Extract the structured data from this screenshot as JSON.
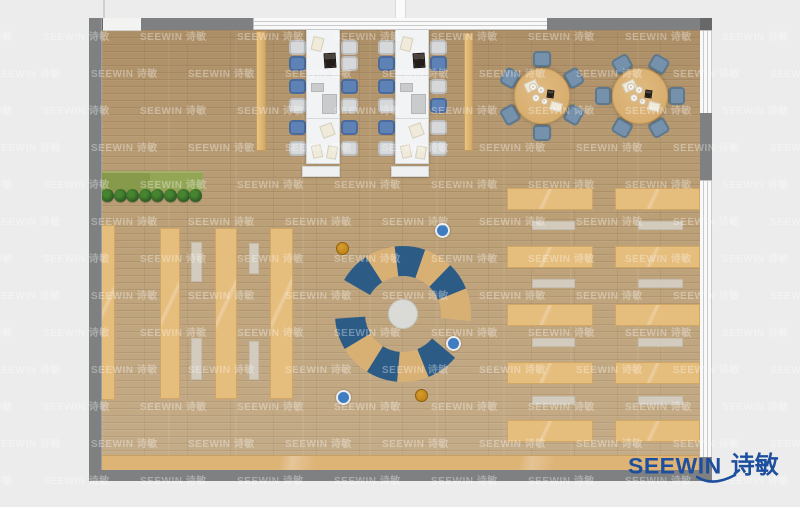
{
  "scene": {
    "description": "top-down furniture layout floor plan of a library reading room",
    "background_color": "#ebeceb",
    "wall_color": "#7e8081",
    "floor_color": "#bca077"
  },
  "watermark": {
    "text": "SEEWIN 诗敏",
    "color": "rgba(255,255,255,0.34)"
  },
  "logo": {
    "brand": "SEEWIN",
    "chinese": "诗敏",
    "color": "#1e4f9f"
  },
  "planter": {
    "plants": 8,
    "x": 101,
    "y": 189,
    "spacing": 12.6
  },
  "desk_area": {
    "chair_tops": [
      11,
      27,
      50,
      69,
      91,
      112
    ],
    "units": [
      {
        "x": 289,
        "chairs_left": [
          "gray",
          "blue",
          "blue",
          "gray",
          "blue",
          "gray"
        ],
        "chairs_right": [
          "gray",
          "gray",
          "blue",
          "gray",
          "blue",
          "gray"
        ]
      },
      {
        "x": 378,
        "chairs_left": [
          "gray",
          "blue",
          "blue",
          "gray",
          "blue",
          "gray"
        ],
        "chairs_right": [
          "gray",
          "blue",
          "gray",
          "blue",
          "gray",
          "gray"
        ]
      }
    ],
    "table_items": [
      {
        "x": 5,
        "y": 7,
        "w": 11,
        "h": 14,
        "rot": 14,
        "type": "paper"
      },
      {
        "x": 17,
        "y": 23,
        "w": 12,
        "h": 15,
        "rot": -4,
        "type": "laptop"
      },
      {
        "x": 4,
        "y": 53,
        "w": 13,
        "h": 9,
        "rot": 0,
        "type": "panel"
      },
      {
        "x": 15,
        "y": 64,
        "w": 15,
        "h": 20,
        "rot": 0,
        "type": "panel"
      },
      {
        "x": 14,
        "y": 94,
        "w": 13,
        "h": 13,
        "rot": -20,
        "type": "paper"
      },
      {
        "x": 5,
        "y": 115,
        "w": 10,
        "h": 13,
        "rot": -12,
        "type": "paper"
      },
      {
        "x": 20,
        "y": 116,
        "w": 10,
        "h": 13,
        "rot": 10,
        "type": "paper"
      }
    ]
  },
  "round_tables": {
    "radius": 28,
    "chair_radius": 37,
    "tables": [
      {
        "cx": 542,
        "cy": 96,
        "angles": [
          270,
          330,
          30,
          90,
          150,
          210
        ]
      },
      {
        "cx": 640,
        "cy": 96,
        "angles": [
          0,
          60,
          120,
          180,
          240,
          300
        ]
      }
    ],
    "items": [
      {
        "dx": -17,
        "dy": -15,
        "w": 13,
        "h": 10,
        "rot": -25,
        "type": "paper"
      },
      {
        "dx": 8,
        "dy": 6,
        "w": 12,
        "h": 9,
        "rot": 15,
        "type": "paper"
      },
      {
        "dx": 5,
        "dy": -6,
        "w": 7,
        "h": 8,
        "rot": 8,
        "type": "laptop"
      },
      {
        "dx": -9,
        "dy": -9,
        "r": 4,
        "type": "plate"
      },
      {
        "dx": -1,
        "dy": -6,
        "r": 4,
        "type": "plate"
      },
      {
        "dx": -6,
        "dy": 2,
        "r": 4,
        "type": "plate"
      },
      {
        "dx": 2,
        "dy": 5,
        "r": 3.5,
        "type": "plate"
      }
    ]
  },
  "shelving_left": {
    "strips": [
      {
        "x": 100,
        "y": 225,
        "w": 15,
        "h": 175
      },
      {
        "x": 160,
        "y": 228,
        "w": 20,
        "h": 171
      },
      {
        "x": 215,
        "y": 228,
        "w": 22,
        "h": 171
      },
      {
        "x": 270,
        "y": 228,
        "w": 23,
        "h": 171
      }
    ],
    "benches": [
      {
        "x": 191,
        "y": 242,
        "w": 11,
        "h": 40
      },
      {
        "x": 191,
        "y": 338,
        "w": 11,
        "h": 42
      },
      {
        "x": 249,
        "y": 243,
        "w": 10,
        "h": 31
      },
      {
        "x": 249,
        "y": 341,
        "w": 10,
        "h": 39
      }
    ]
  },
  "tall_shelves": [
    {
      "x": 256,
      "y": 31,
      "w": 10,
      "h": 120
    },
    {
      "x": 464,
      "y": 33,
      "w": 9,
      "h": 118
    }
  ],
  "right_desks": {
    "cols": [
      {
        "x": 507,
        "w": 86
      },
      {
        "x": 615,
        "w": 85
      }
    ],
    "rows_y": [
      188,
      246,
      304,
      362,
      420
    ],
    "row_h": 22,
    "benches_x": [
      {
        "x": 532,
        "w": 43
      },
      {
        "x": 638,
        "w": 45
      }
    ],
    "benches_y": [
      221,
      279,
      338,
      396
    ],
    "bench_h": 9
  },
  "reading_circle": {
    "cx": 403,
    "cy": 314,
    "ring_mid_r": 53,
    "ring_width": 30,
    "colors": {
      "blue": "#2c5c86",
      "tan": "#d9b074"
    },
    "segments": [
      {
        "a1": 210,
        "a2": 237,
        "c": "blue"
      },
      {
        "a1": 237,
        "a2": 263,
        "c": "tan"
      },
      {
        "a1": 263,
        "a2": 289,
        "c": "blue"
      },
      {
        "a1": 289,
        "a2": 314,
        "c": "tan"
      },
      {
        "a1": 314,
        "a2": 338,
        "c": "blue"
      },
      {
        "a1": 338,
        "a2": 366,
        "c": "tan"
      },
      {
        "a1": 40,
        "a2": 68,
        "c": "blue"
      },
      {
        "a1": 68,
        "a2": 95,
        "c": "tan"
      },
      {
        "a1": 95,
        "a2": 122,
        "c": "blue"
      },
      {
        "a1": 122,
        "a2": 149,
        "c": "tan"
      },
      {
        "a1": 149,
        "a2": 176,
        "c": "blue"
      }
    ],
    "stools": [
      {
        "x": 442,
        "y": 230,
        "c": "blue"
      },
      {
        "x": 343,
        "y": 249,
        "c": "orange"
      },
      {
        "x": 453,
        "y": 343,
        "c": "blue"
      },
      {
        "x": 343,
        "y": 397,
        "c": "blue"
      },
      {
        "x": 422,
        "y": 396,
        "c": "orange"
      }
    ]
  }
}
